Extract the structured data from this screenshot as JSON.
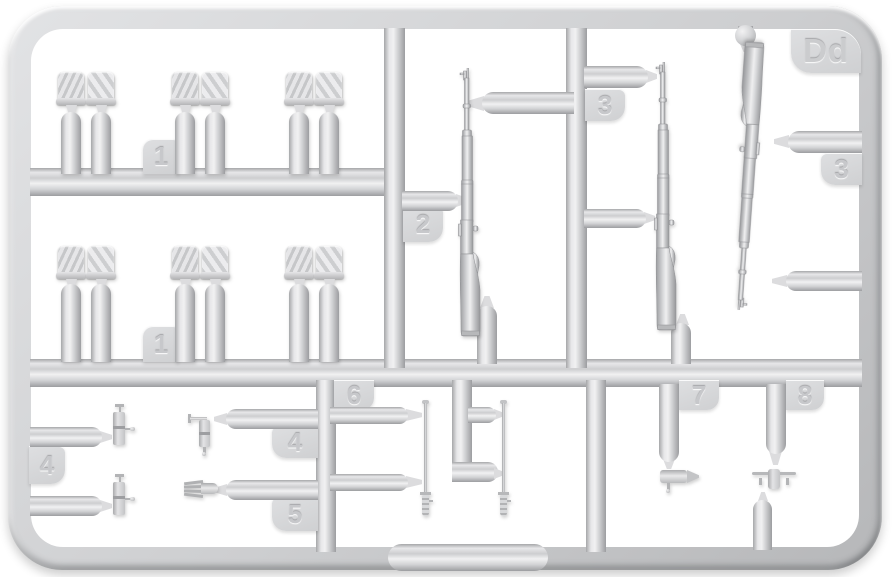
{
  "sprue": {
    "corner_label": "Dd",
    "tags": {
      "part1_row1": "1",
      "part1_row2": "1",
      "part2": "2",
      "part3_inner": "3",
      "part3_outer": "3",
      "part4_left": "4",
      "part4_right": "4",
      "part5": "5",
      "part6": "6",
      "part7": "7",
      "part8": "8"
    },
    "colors": {
      "background": "#ffffff",
      "plastic_highlight": "#f1f1f2",
      "plastic_mid": "#d2d3d5",
      "plastic_shadow": "#9c9da0"
    },
    "parts_inventory": [
      {
        "tag": "1",
        "shape": "canteen-in-cover-pair",
        "count": 6
      },
      {
        "tag": "2",
        "shape": "rifle",
        "count": 1
      },
      {
        "tag": "3",
        "shape": "rifle",
        "count": 2
      },
      {
        "tag": "4",
        "shape": "small-cylinder-with-pins",
        "count": 3
      },
      {
        "tag": "5",
        "shape": "cleaning-brush",
        "count": 1
      },
      {
        "tag": "6",
        "shape": "cleaning-rod",
        "count": 2
      },
      {
        "tag": "7",
        "shape": "small-pointed-cylinder",
        "count": 1
      },
      {
        "tag": "8",
        "shape": "small-cross-fitting",
        "count": 1
      }
    ]
  }
}
